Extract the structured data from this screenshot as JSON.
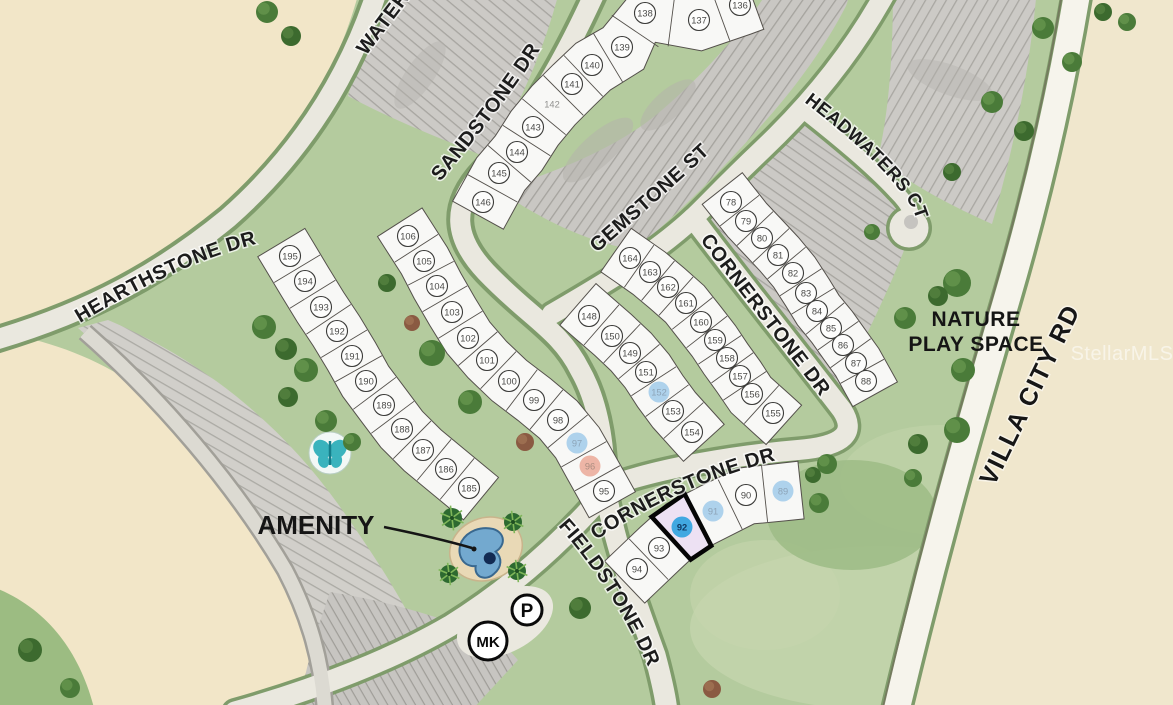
{
  "map": {
    "selected_lot": "92",
    "streets": {
      "waterstone": "WATERSTONE DR",
      "hearthstone": "HEARTHSTONE DR",
      "sandstone": "SANDSTONE DR",
      "gemstone": "GEMSTONE ST",
      "cornerstone_upper": "CORNERSTONE DR",
      "cornerstone_lower": "CORNERSTONE DR",
      "fieldstone": "FIELDSTONE DR",
      "headwaters": "HEADWATERS CT",
      "villa_city": "VILLA CITY RD"
    },
    "labels": {
      "amenity": "AMENITY",
      "nature_line1": "NATURE",
      "nature_line2": "PLAY SPACE",
      "parking": "P",
      "mail_kiosk": "MK",
      "watermark": "StellarMLS"
    },
    "colors": {
      "tan": "#f2e6c8",
      "green_base": "#b4cb9e",
      "road": "#eae8df",
      "road_edge": "#7f9c6b",
      "gray_block": "#cbc9c5",
      "lot_fill": "#f8f8f6",
      "lot_line": "#54504b",
      "highlight_blue": "#aed2ec",
      "highlight_blue_text": "#8da4b8",
      "highlight_red": "#edb5a6",
      "highlight_red_text": "#ab8d80",
      "selected_blue": "#41a8e1",
      "selected_blue_text": "#113b66",
      "selected_parcel_fill": "#ede1f3",
      "pool_blue": "#73a9cf",
      "amenity_teal": "#3ab3bd"
    },
    "lot_groups": [
      {
        "name": "hearthstone-row",
        "band": {
          "hw1": 28,
          "hw2": 27,
          "ext": 16
        },
        "lots": [
          {
            "n": "195",
            "x": 290,
            "y": 256
          },
          {
            "n": "194",
            "x": 305,
            "y": 281
          },
          {
            "n": "193",
            "x": 321,
            "y": 307
          },
          {
            "n": "192",
            "x": 337,
            "y": 331
          },
          {
            "n": "191",
            "x": 352,
            "y": 356
          },
          {
            "n": "190",
            "x": 366,
            "y": 381
          },
          {
            "n": "189",
            "x": 384,
            "y": 405
          },
          {
            "n": "188",
            "x": 402,
            "y": 429
          },
          {
            "n": "187",
            "x": 423,
            "y": 450
          },
          {
            "n": "186",
            "x": 446,
            "y": 469
          },
          {
            "n": "185",
            "x": 469,
            "y": 488
          }
        ]
      },
      {
        "name": "sandstone-fan",
        "band": {
          "hw1": 27,
          "hw2": 31,
          "ext": 14
        },
        "lots": [
          {
            "n": "136",
            "x": 740,
            "y": 5
          },
          {
            "n": "137",
            "x": 699,
            "y": 20
          },
          {
            "n": "138",
            "x": 645,
            "y": 13
          },
          {
            "n": "139",
            "x": 622,
            "y": 47
          },
          {
            "n": "140",
            "x": 592,
            "y": 65
          },
          {
            "n": "141",
            "x": 572,
            "y": 84
          },
          {
            "n": "142",
            "x": 552,
            "y": 104,
            "plain": true
          },
          {
            "n": "143",
            "x": 533,
            "y": 127
          },
          {
            "n": "144",
            "x": 517,
            "y": 152
          },
          {
            "n": "145",
            "x": 499,
            "y": 173
          },
          {
            "n": "146",
            "x": 483,
            "y": 202
          }
        ]
      },
      {
        "name": "sandstone-west-wedge",
        "band": {
          "hw1": 27,
          "hw2": 26,
          "ext": 16
        },
        "lots": [
          {
            "n": "95",
            "x": 604,
            "y": 491
          },
          {
            "n": "96",
            "x": 590,
            "y": 466,
            "hl": "red"
          },
          {
            "n": "97",
            "x": 577,
            "y": 443,
            "hl": "blue"
          },
          {
            "n": "98",
            "x": 558,
            "y": 420
          },
          {
            "n": "99",
            "x": 534,
            "y": 400
          },
          {
            "n": "100",
            "x": 509,
            "y": 381
          },
          {
            "n": "101",
            "x": 487,
            "y": 360
          },
          {
            "n": "102",
            "x": 468,
            "y": 338
          },
          {
            "n": "103",
            "x": 452,
            "y": 312
          },
          {
            "n": "104",
            "x": 437,
            "y": 286
          },
          {
            "n": "105",
            "x": 424,
            "y": 261
          },
          {
            "n": "106",
            "x": 408,
            "y": 236
          }
        ]
      },
      {
        "name": "gemstone-block-west",
        "band": {
          "hw1": 26,
          "hw2": 29,
          "ext": 16
        },
        "lots": [
          {
            "n": "148",
            "x": 589,
            "y": 316
          },
          {
            "n": "150",
            "x": 612,
            "y": 336
          },
          {
            "n": "149",
            "x": 630,
            "y": 353
          },
          {
            "n": "151",
            "x": 646,
            "y": 372
          },
          {
            "n": "152",
            "x": 659,
            "y": 392,
            "hl": "blue"
          },
          {
            "n": "153",
            "x": 673,
            "y": 411
          },
          {
            "n": "154",
            "x": 692,
            "y": 432
          }
        ]
      },
      {
        "name": "gemstone-block-east",
        "band": {
          "hw1": 28,
          "hw2": 25,
          "ext": 16
        },
        "lots": [
          {
            "n": "164",
            "x": 630,
            "y": 258
          },
          {
            "n": "163",
            "x": 650,
            "y": 272
          },
          {
            "n": "162",
            "x": 668,
            "y": 287
          },
          {
            "n": "161",
            "x": 686,
            "y": 303
          },
          {
            "n": "160",
            "x": 701,
            "y": 322
          },
          {
            "n": "159",
            "x": 715,
            "y": 340
          },
          {
            "n": "158",
            "x": 727,
            "y": 358
          },
          {
            "n": "157",
            "x": 740,
            "y": 376
          },
          {
            "n": "156",
            "x": 752,
            "y": 394
          },
          {
            "n": "155",
            "x": 773,
            "y": 413
          }
        ]
      },
      {
        "name": "cornerstone-east-row",
        "band": {
          "hw1": 24,
          "hw2": 27,
          "ext": 16
        },
        "lots": [
          {
            "n": "78",
            "x": 731,
            "y": 202
          },
          {
            "n": "79",
            "x": 746,
            "y": 221
          },
          {
            "n": "80",
            "x": 762,
            "y": 238
          },
          {
            "n": "81",
            "x": 778,
            "y": 255
          },
          {
            "n": "82",
            "x": 793,
            "y": 273
          },
          {
            "n": "83",
            "x": 806,
            "y": 293
          },
          {
            "n": "84",
            "x": 817,
            "y": 311
          },
          {
            "n": "85",
            "x": 831,
            "y": 328
          },
          {
            "n": "86",
            "x": 843,
            "y": 345
          },
          {
            "n": "87",
            "x": 856,
            "y": 363
          },
          {
            "n": "88",
            "x": 866,
            "y": 381
          }
        ]
      },
      {
        "name": "fieldstone-row",
        "band": {
          "hw1": 30,
          "hw2": 28,
          "ext": 18
        },
        "lots": [
          {
            "n": "94",
            "x": 637,
            "y": 569
          },
          {
            "n": "93",
            "x": 659,
            "y": 548
          },
          {
            "n": "92",
            "x": 682,
            "y": 527,
            "hl": "solid"
          },
          {
            "n": "91",
            "x": 713,
            "y": 511,
            "hl": "blue"
          },
          {
            "n": "90",
            "x": 746,
            "y": 495
          },
          {
            "n": "89",
            "x": 783,
            "y": 491,
            "hl": "blue"
          }
        ]
      }
    ],
    "trees": [
      [
        267,
        12,
        11,
        0
      ],
      [
        291,
        36,
        10,
        1
      ],
      [
        264,
        327,
        12,
        0
      ],
      [
        286,
        349,
        11,
        1
      ],
      [
        306,
        370,
        12,
        0
      ],
      [
        288,
        397,
        10,
        1
      ],
      [
        326,
        421,
        11,
        0
      ],
      [
        352,
        442,
        9,
        0
      ],
      [
        387,
        283,
        9,
        1
      ],
      [
        432,
        353,
        13,
        0
      ],
      [
        470,
        402,
        12,
        0
      ],
      [
        412,
        323,
        8,
        2
      ],
      [
        525,
        442,
        9,
        2
      ],
      [
        452,
        518,
        10,
        3
      ],
      [
        513,
        522,
        9,
        3
      ],
      [
        449,
        574,
        9,
        3
      ],
      [
        517,
        571,
        9,
        3
      ],
      [
        580,
        608,
        11,
        1
      ],
      [
        712,
        689,
        9,
        2
      ],
      [
        827,
        464,
        10,
        0
      ],
      [
        813,
        475,
        8,
        1
      ],
      [
        819,
        503,
        10,
        0
      ],
      [
        957,
        283,
        14,
        0
      ],
      [
        938,
        296,
        10,
        1
      ],
      [
        905,
        318,
        11,
        0
      ],
      [
        963,
        370,
        12,
        0
      ],
      [
        957,
        430,
        13,
        0
      ],
      [
        918,
        444,
        10,
        1
      ],
      [
        913,
        478,
        9,
        0
      ],
      [
        992,
        102,
        11,
        0
      ],
      [
        1024,
        131,
        10,
        1
      ],
      [
        1043,
        28,
        11,
        0
      ],
      [
        1072,
        62,
        10,
        0
      ],
      [
        1103,
        12,
        9,
        1
      ],
      [
        1127,
        22,
        9,
        0
      ],
      [
        952,
        172,
        9,
        1
      ],
      [
        872,
        232,
        8,
        0
      ],
      [
        30,
        650,
        12,
        1
      ],
      [
        70,
        688,
        10,
        0
      ]
    ]
  }
}
